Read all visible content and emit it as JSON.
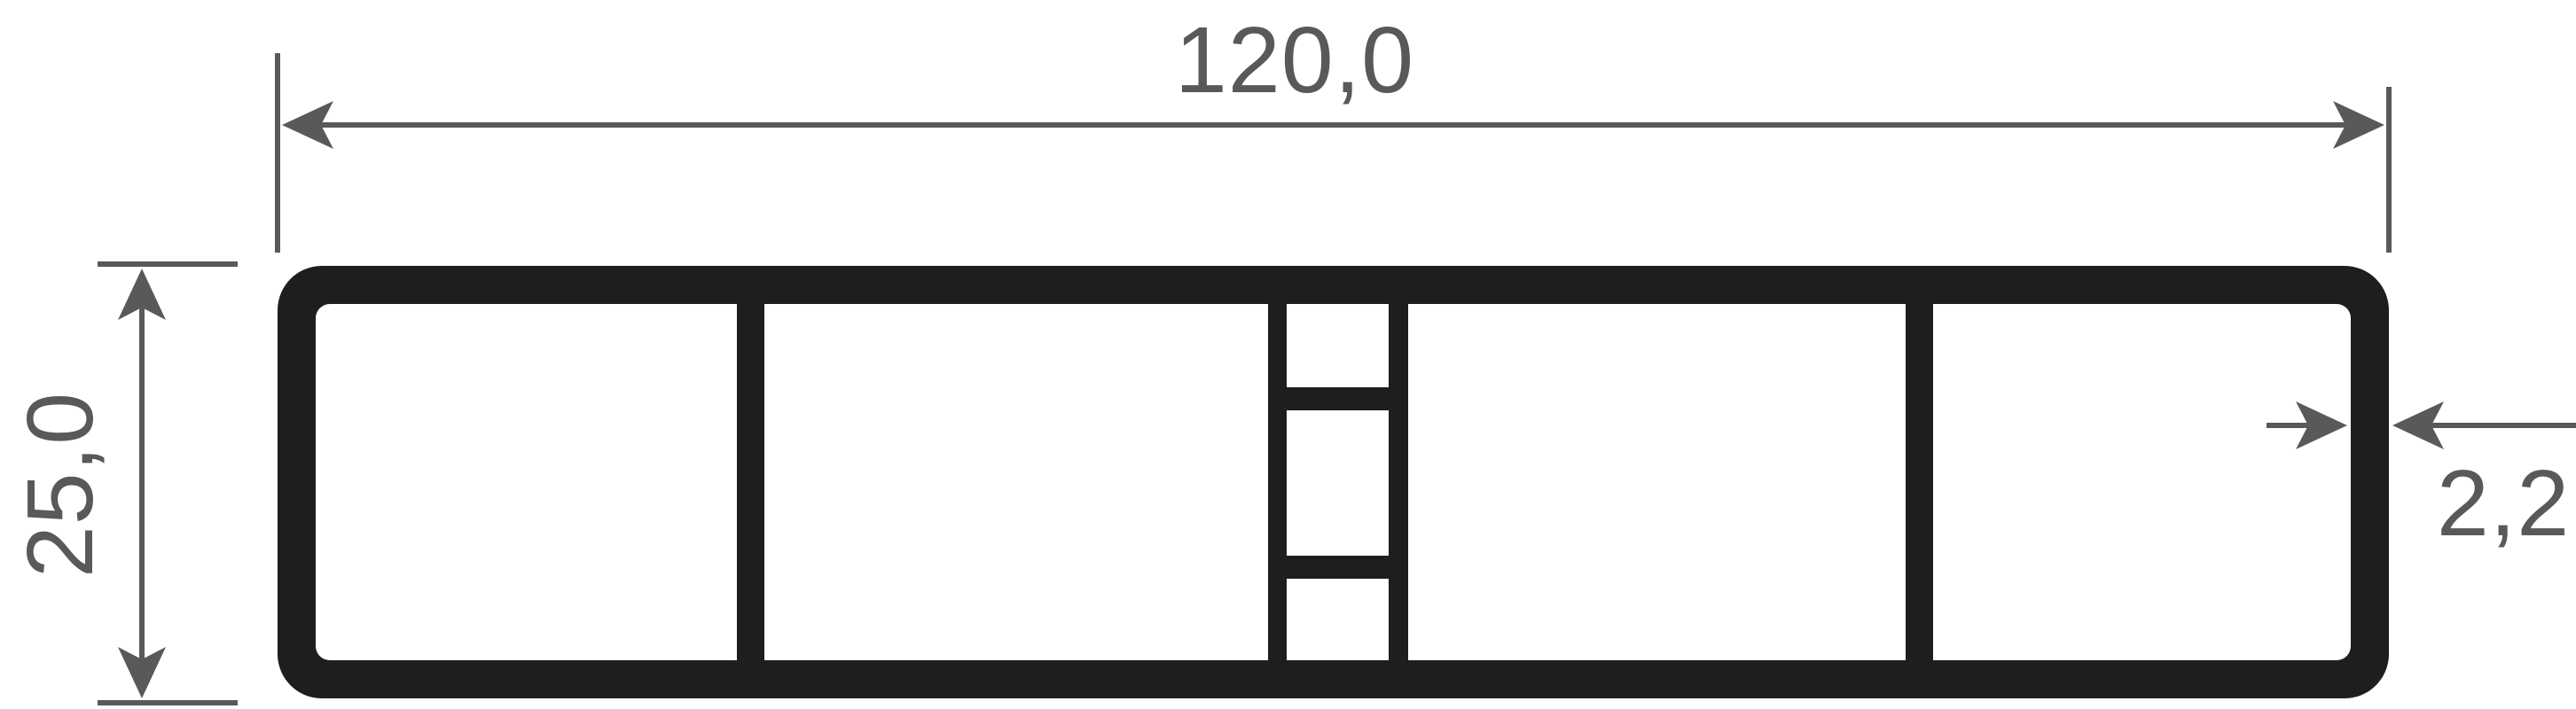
{
  "drawing": {
    "kind": "profile-cross-section",
    "labels": {
      "overall_width": "120,0",
      "overall_height": "25,0",
      "wall_thickness": "2,2"
    },
    "colors": {
      "profile": "#201d1e",
      "dimension": "#58595b",
      "background": "#ffffff"
    }
  }
}
